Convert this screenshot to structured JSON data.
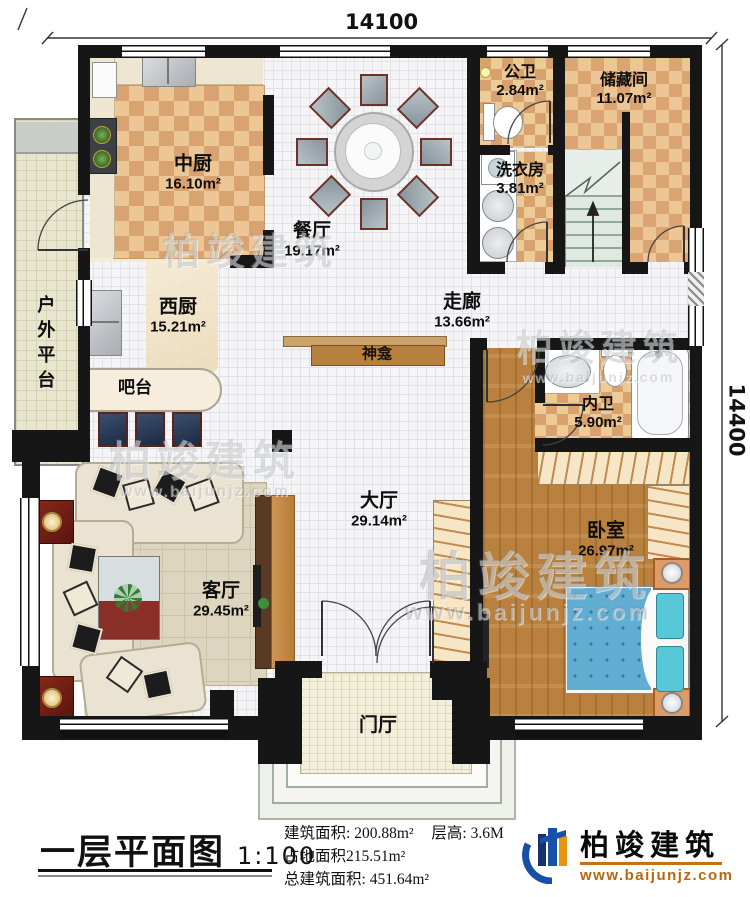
{
  "dimensions": {
    "top": "14100",
    "right": "14400"
  },
  "rooms": {
    "zhongchu": {
      "name": "中厨",
      "area": "16.10m²"
    },
    "canting": {
      "name": "餐厅",
      "area": "19.17m²"
    },
    "gongwei": {
      "name": "公卫",
      "area": "2.84m²"
    },
    "chucang": {
      "name": "储藏间",
      "area": "11.07m²"
    },
    "xiyi": {
      "name": "洗衣房",
      "area": "3.81m²"
    },
    "xichu": {
      "name": "西厨",
      "area": "15.21m²"
    },
    "zoulang": {
      "name": "走廊",
      "area": "13.66m²"
    },
    "neiwei": {
      "name": "内卫",
      "area": "5.90m²"
    },
    "dating": {
      "name": "大厅",
      "area": "29.14m²"
    },
    "woshi": {
      "name": "卧室",
      "area": "26.97m²"
    },
    "keting": {
      "name": "客厅",
      "area": "29.45m²"
    },
    "menting": {
      "name": "门厅"
    },
    "pingtai": {
      "name": "户外平台"
    },
    "batai": {
      "name": "吧台"
    },
    "shenkan": {
      "name": "神龛"
    }
  },
  "legend": {
    "title": "一层平面图",
    "scale": "1:100",
    "area_label": "建筑面积:",
    "area_value": "200.88m²",
    "height_label": "层高:",
    "height_value": "3.6M",
    "land_line": "占地面积215.51m²",
    "total_label": "总建筑面积:",
    "total_value": "451.64m²"
  },
  "logo": {
    "name": "柏竣建筑",
    "url": "www.baijunjz.com"
  },
  "watermark": {
    "brand": "柏竣建筑",
    "site": "www.baijunjz.com"
  },
  "colors": {
    "wall": "#161616",
    "checker": "#d9a371",
    "wood": "#b9813d",
    "logo_blue": "#1850a8",
    "logo_orange": "#e8940f"
  }
}
